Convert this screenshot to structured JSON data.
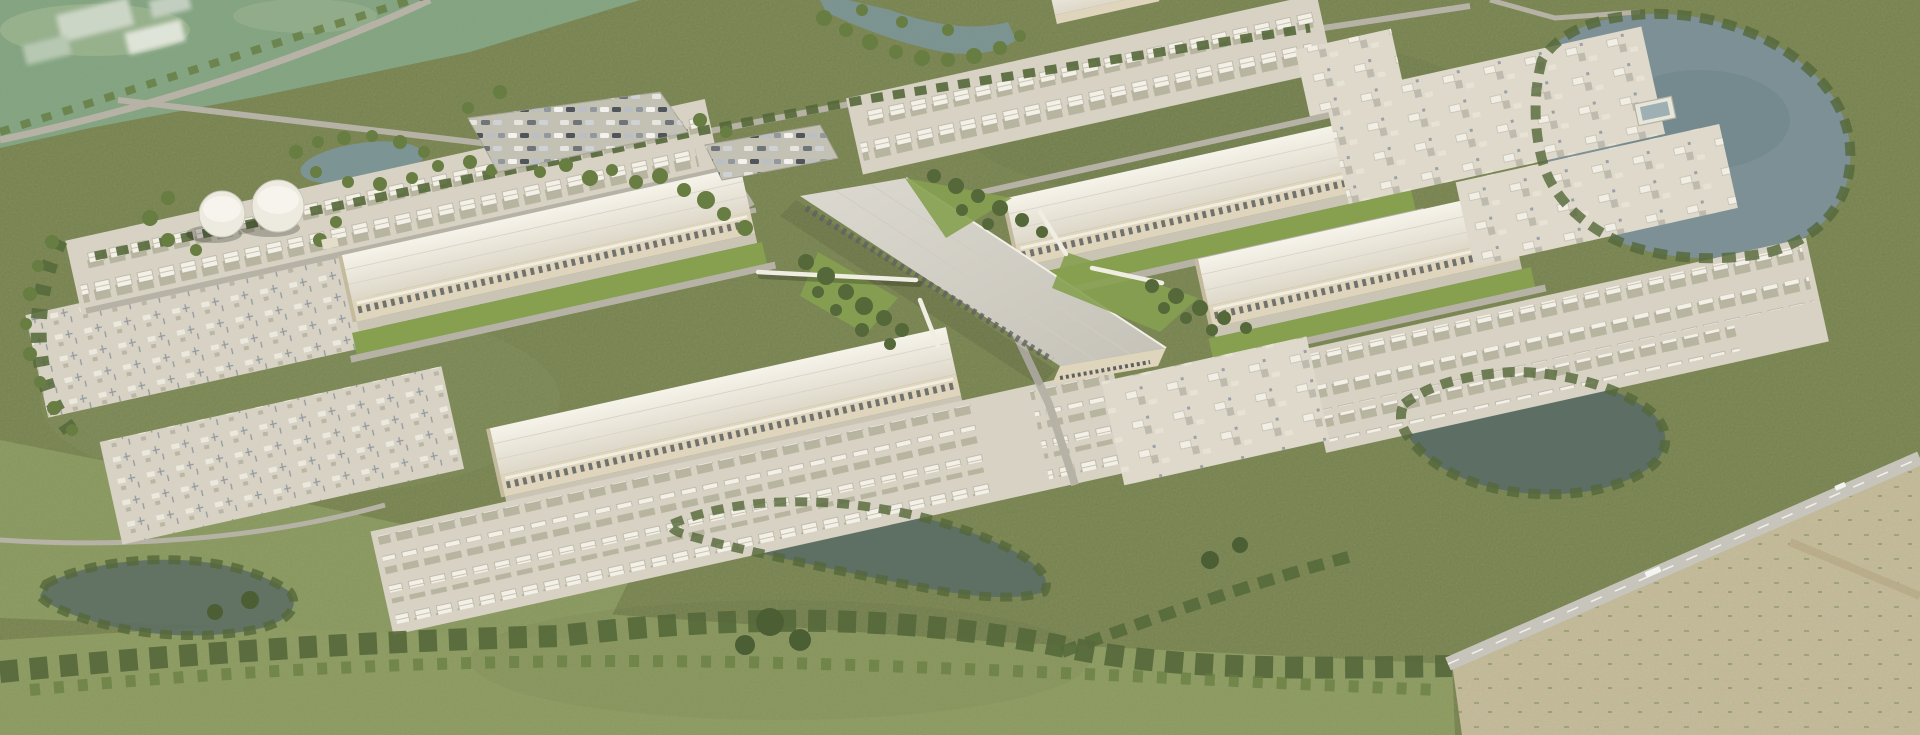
{
  "scene": {
    "type": "aerial-architectural-rendering",
    "subject": "hyperscale data center campus in rural grassland",
    "view": "oblique aerial view, daytime, no visible text or UI",
    "visible_text": "none"
  },
  "palette": {
    "base": "#747f4c",
    "teal": "#7fa383",
    "mint": "#9cb794",
    "field": "#8a995e",
    "field2": "#87965c",
    "tan": "#cabd9f",
    "pond": "#7c9095",
    "pond_dark": "#5d6f64",
    "wetland": "#7d97a0",
    "road": "#b6b3a6",
    "highway": "#c7c4bc",
    "dash": "#f0efe9",
    "pad": "#d7d2c3",
    "pad_light": "#ded9cb",
    "roof": "#eae5d8",
    "roof_edge": "#f6f3ea",
    "spine1": "#dcd9d0",
    "spine2": "#c5c2b8",
    "wall": "#ded5bc",
    "wall_dark": "#c4bb9f",
    "dock": "#5f6160",
    "canopy": "#f1ede0",
    "concrete": "#c9c4b4",
    "lawn": "#86a050",
    "tree": "#55683a",
    "tree2": "#677d42",
    "tank": "#edebe0",
    "vehicle_white": "#f4f4f0"
  },
  "campus": {
    "data_halls": [
      {
        "id": "hall-upper-left",
        "position": "upper-left",
        "features": "loading docks along south face, lawn strip"
      },
      {
        "id": "hall-lower-left",
        "position": "lower-left",
        "features": "loading docks along south face, lawn strip"
      },
      {
        "id": "hall-upper-right",
        "position": "upper-right",
        "features": "loading docks along south face, lawn strip"
      },
      {
        "id": "hall-lower-right",
        "position": "lower-right",
        "features": "loading docks along south face, lawn strip"
      }
    ],
    "central_spine": {
      "id": "central-admin-spine",
      "orientation": "diagonal, crossing between the four halls",
      "connector_ramps": 4
    },
    "equipment_yards": [
      {
        "id": "yard-northwest",
        "rows": 2
      },
      {
        "id": "yard-northeast",
        "rows": 2
      },
      {
        "id": "yard-south-central",
        "rows": 3
      },
      {
        "id": "yard-southeast",
        "rows": 3
      }
    ],
    "substations": [
      {
        "id": "substation-west",
        "pads": 2
      },
      {
        "id": "substation-east",
        "pads": 3
      }
    ],
    "storage_pad_boxes": true,
    "water_tanks": 2,
    "parking": {
      "lots": 2,
      "cars_visible_approx": 60
    },
    "ponds": 5,
    "wetland_stream": true,
    "highway": {
      "lanes": 2,
      "dashed_center_line": true,
      "vehicles_visible": 2
    },
    "landscape": "olive shrubland, mowed green fields, tree belts, dry tan field in far corner"
  }
}
